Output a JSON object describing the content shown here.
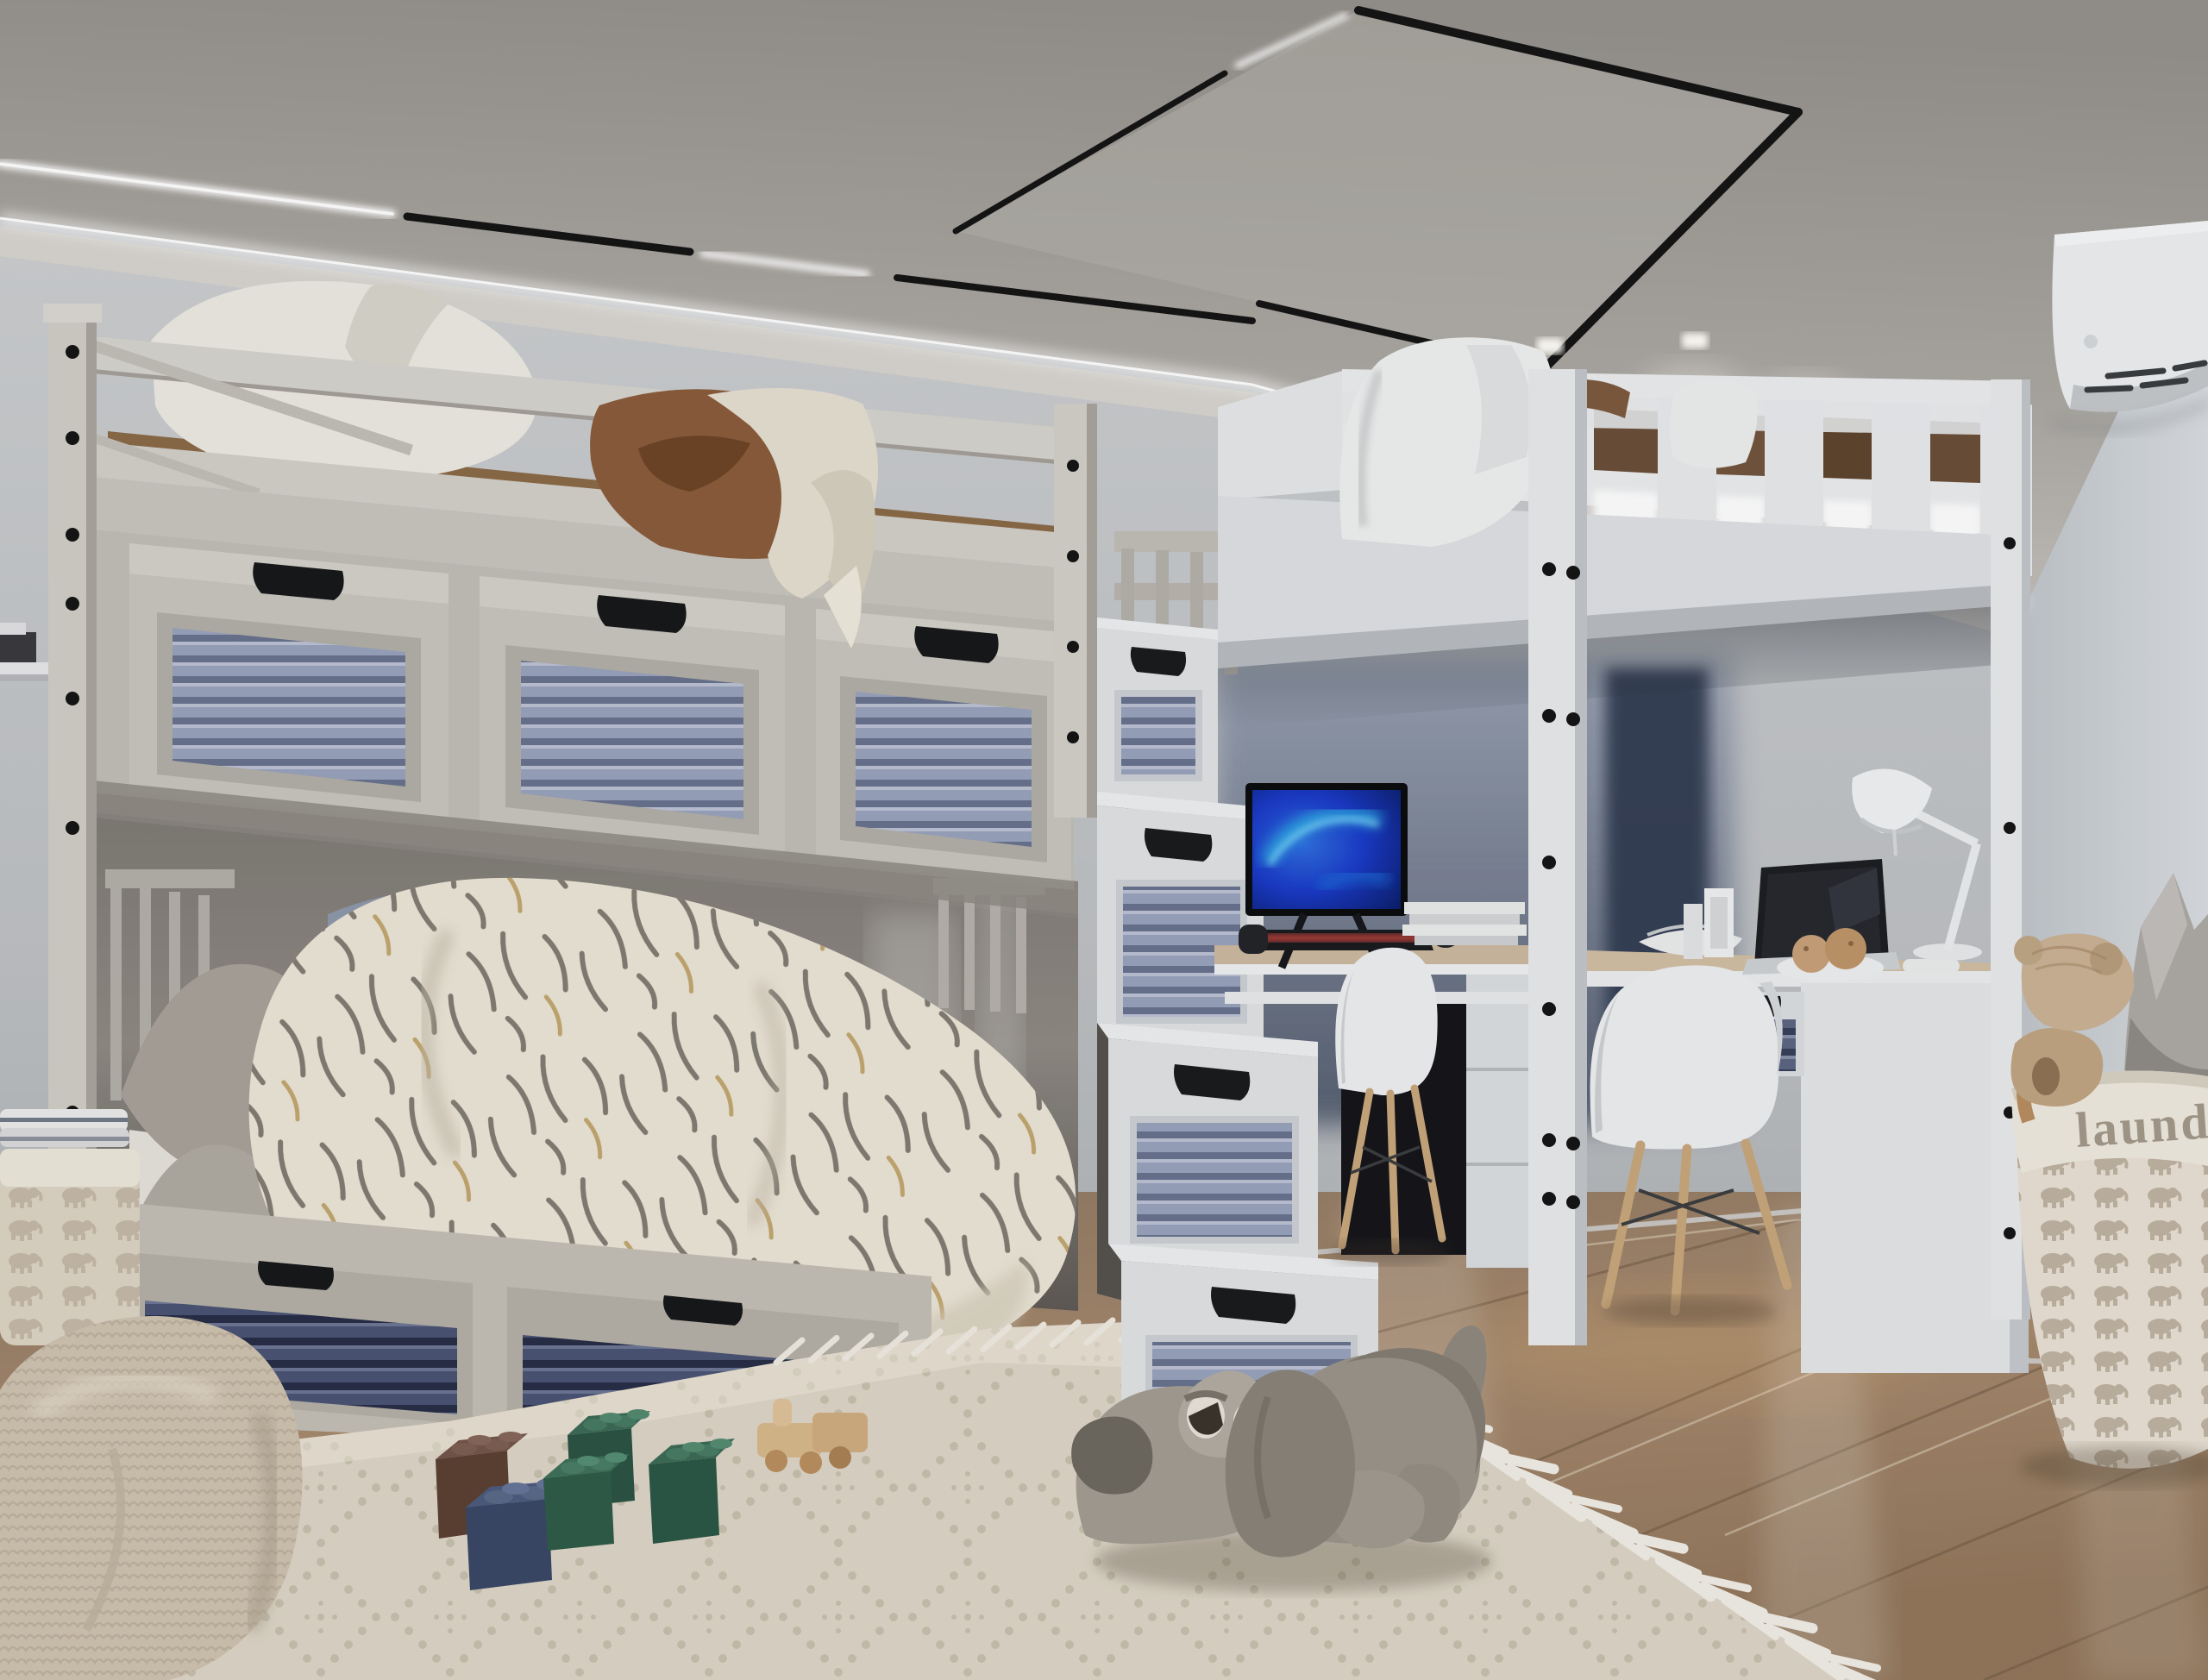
{
  "scene": {
    "description": "Photorealistic 3D render of a kids bedroom: greige bunk bed with louvered storage drawers and a storage-stair chest, a white loft bed over a two-desk computer study nook, gray plush dog and felt building blocks on a beaded cream rug, laundry basket with wooden teddy, wall air conditioner, track and cove ceiling lighting",
    "room_type": "children bedroom interior"
  },
  "laundry_basket": {
    "label": "laundry"
  },
  "palette": {
    "ceiling": "#a8a49f",
    "wall": "#c6c9cc",
    "back_wall": "#b3b9c0",
    "window_glow": "#3a4456",
    "floor_wood": "#a08468",
    "rug": "#ded7c8",
    "rug_pattern": "#c7beab",
    "bunk_frame": "#c9c5be",
    "loft_frame": "#eceef0",
    "louver_light": "#9aa3bd",
    "louver_dark": "#4a5474",
    "duvet": "#ece6d8",
    "blanket_brown": "#8a5c3a",
    "screen_blue": "#1e44c8",
    "screen_aurora": "#56d9f5",
    "keyboard_backlight": "#d8493f",
    "chair_shell": "#eff0f1",
    "chair_leg_wood": "#c9a87c",
    "dog_plush": "#9b948a",
    "block_green": "#2e5c48",
    "block_navy": "#3c4a68",
    "block_brown": "#654437",
    "basket_fabric": "#e9e1d4",
    "elephant_print": "#bcae9c",
    "ac_unit": "#eef0f2",
    "track_light": "#111111",
    "cove_light": "#ffffff"
  },
  "objects": [
    "bunk-bed",
    "upper-bunk-drawers",
    "lower-bed",
    "storage-stairs",
    "loft-bed",
    "desk-monitor",
    "gaming-keyboard",
    "laptop",
    "desk-lamp",
    "eames-chair-left",
    "eames-chair-right",
    "pc-tower",
    "laundry-basket",
    "wooden-teddy",
    "gray-pillow",
    "bean-bag",
    "towel-basket",
    "plush-dog",
    "felt-blocks",
    "wooden-train",
    "air-conditioner",
    "ceiling-track-light",
    "led-cove-light",
    "beaded-rug"
  ]
}
